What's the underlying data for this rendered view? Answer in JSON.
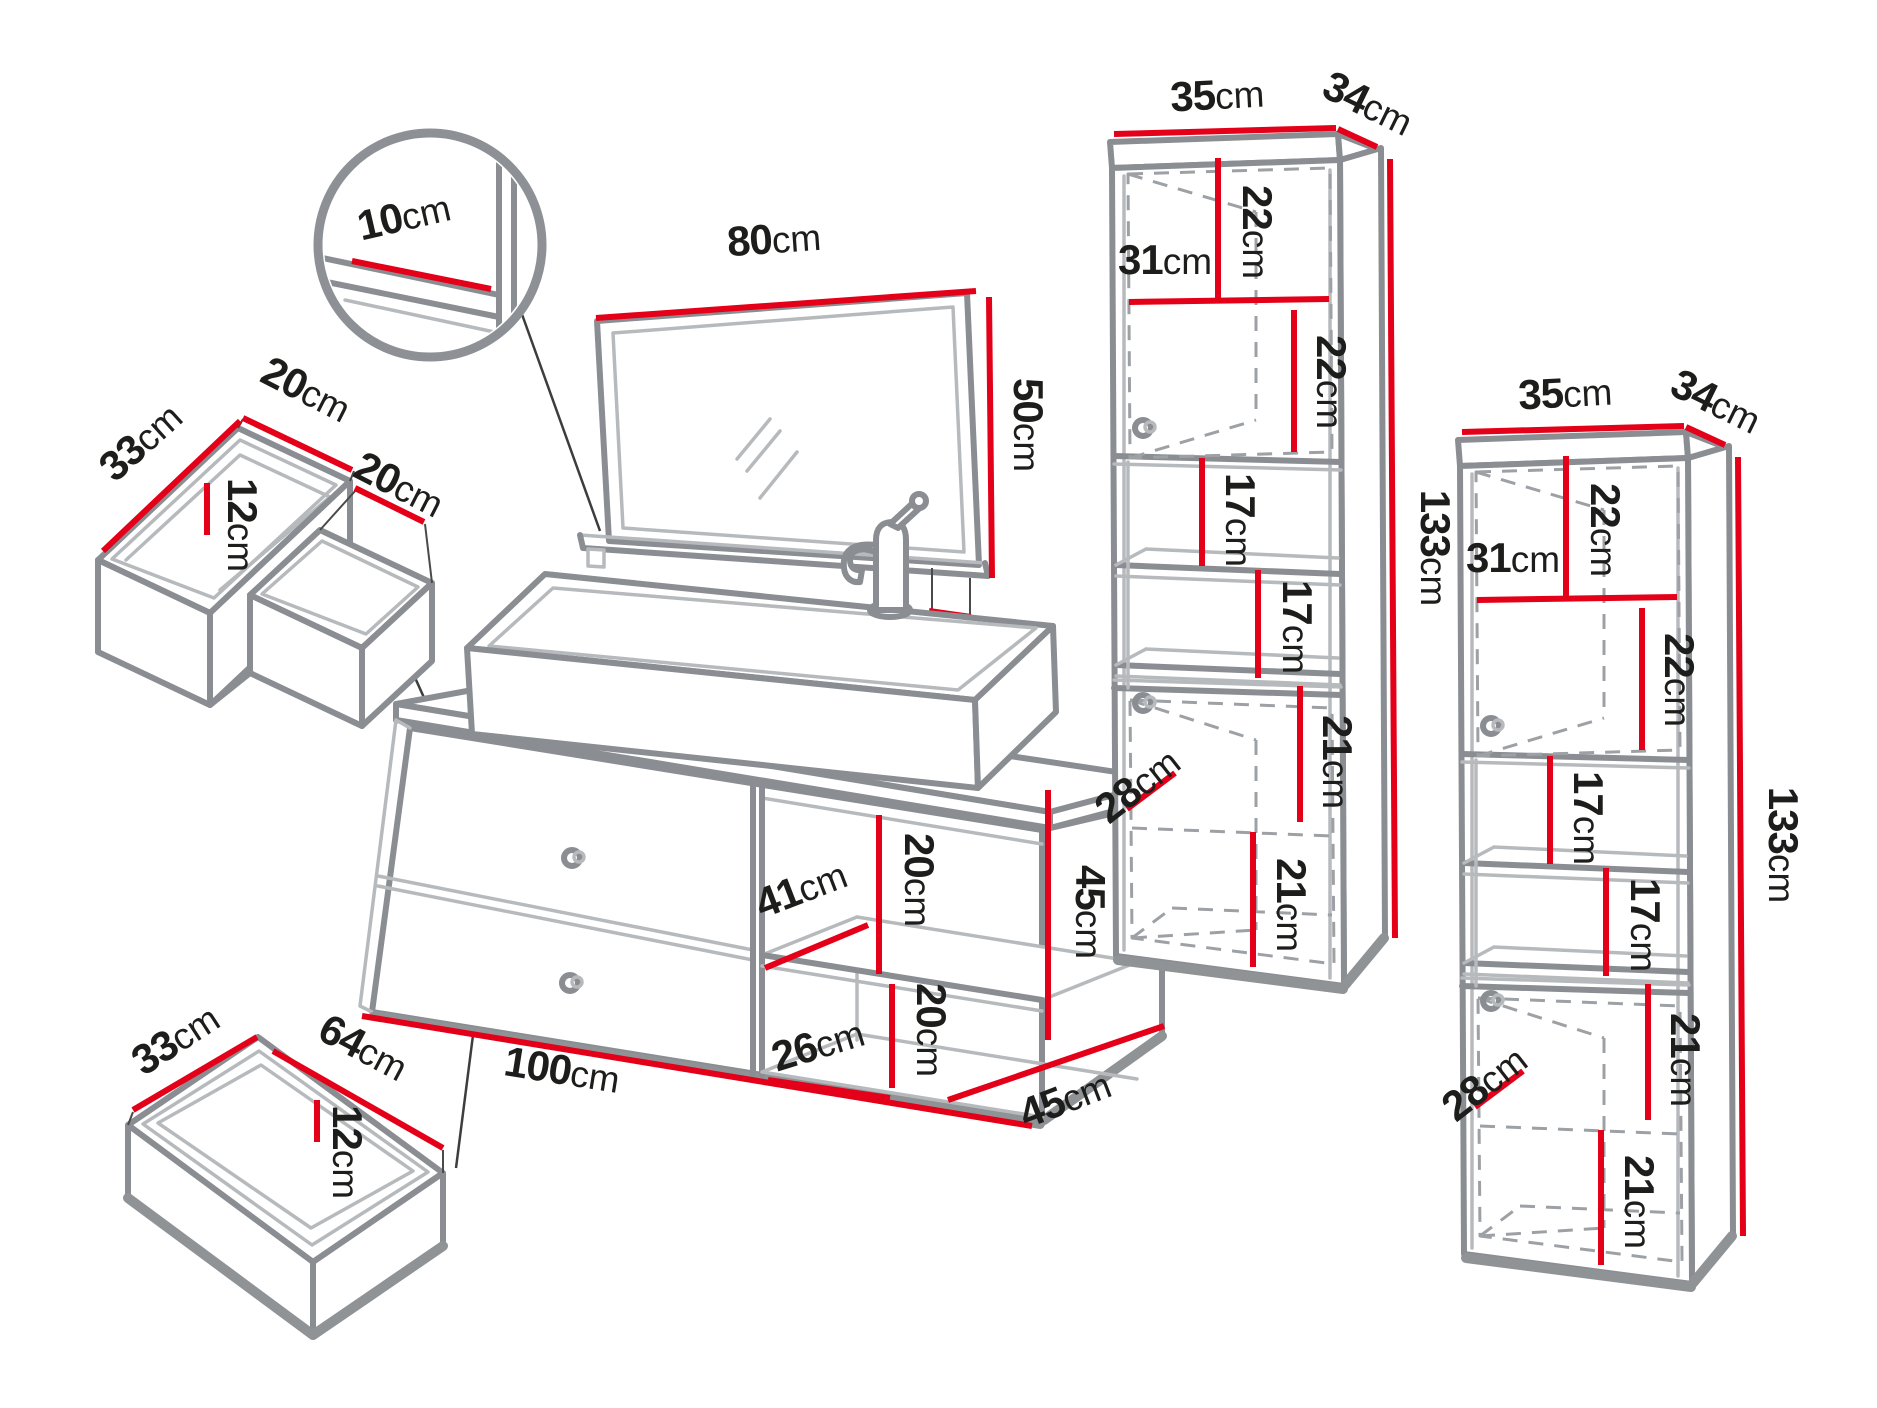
{
  "meta": {
    "background": "#ffffff",
    "dimension_line_color": "#e30018",
    "drawing_line_color": "#8a8e92",
    "text_color": "#1d1d1b",
    "unit": "cm"
  },
  "dims": {
    "d10": {
      "v": "10",
      "u": "cm"
    },
    "ud33": {
      "v": "33",
      "u": "cm"
    },
    "ud20a": {
      "v": "20",
      "u": "cm"
    },
    "ud12": {
      "v": "12",
      "u": "cm"
    },
    "ud20b": {
      "v": "20",
      "u": "cm"
    },
    "bd33": {
      "v": "33",
      "u": "cm"
    },
    "bd64": {
      "v": "64",
      "u": "cm"
    },
    "bd12": {
      "v": "12",
      "u": "cm"
    },
    "m80": {
      "v": "80",
      "u": "cm"
    },
    "m50": {
      "v": "50",
      "u": "cm"
    },
    "m12": {
      "v": "12",
      "u": "cm"
    },
    "v20a": {
      "v": "20",
      "u": "cm"
    },
    "v41": {
      "v": "41",
      "u": "cm"
    },
    "v20b": {
      "v": "20",
      "u": "cm"
    },
    "v26": {
      "v": "26",
      "u": "cm"
    },
    "v45h": {
      "v": "45",
      "u": "cm"
    },
    "v45d": {
      "v": "45",
      "u": "cm"
    },
    "v100": {
      "v": "100",
      "u": "cm"
    },
    "c1w35": {
      "v": "35",
      "u": "cm"
    },
    "c1d34": {
      "v": "34",
      "u": "cm"
    },
    "c1a22": {
      "v": "22",
      "u": "cm"
    },
    "c1s31": {
      "v": "31",
      "u": "cm"
    },
    "c1b22": {
      "v": "22",
      "u": "cm"
    },
    "c1c17": {
      "v": "17",
      "u": "cm"
    },
    "c1d17": {
      "v": "17",
      "u": "cm"
    },
    "c1e21": {
      "v": "21",
      "u": "cm"
    },
    "c1f28": {
      "v": "28",
      "u": "cm"
    },
    "c1g21": {
      "v": "21",
      "u": "cm"
    },
    "c1h133": {
      "v": "133",
      "u": "cm"
    },
    "c2w35": {
      "v": "35",
      "u": "cm"
    },
    "c2d34": {
      "v": "34",
      "u": "cm"
    },
    "c2a22": {
      "v": "22",
      "u": "cm"
    },
    "c2s31": {
      "v": "31",
      "u": "cm"
    },
    "c2b22": {
      "v": "22",
      "u": "cm"
    },
    "c2c17": {
      "v": "17",
      "u": "cm"
    },
    "c2d17": {
      "v": "17",
      "u": "cm"
    },
    "c2e21": {
      "v": "21",
      "u": "cm"
    },
    "c2f28": {
      "v": "28",
      "u": "cm"
    },
    "c2g21": {
      "v": "21",
      "u": "cm"
    },
    "c2h133": {
      "v": "133",
      "u": "cm"
    }
  }
}
